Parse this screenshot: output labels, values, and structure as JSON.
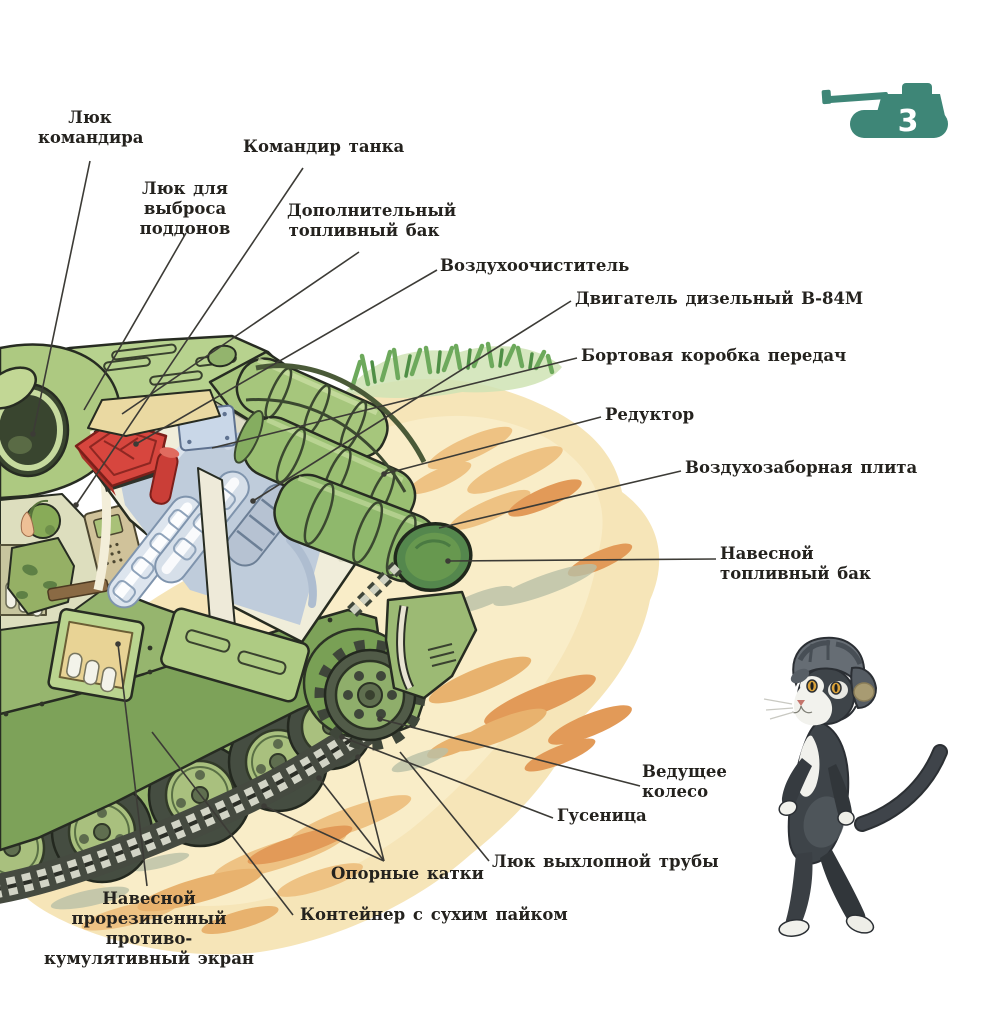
{
  "page": {
    "number": "3"
  },
  "theme": {
    "badge_color": "#3e8677",
    "text_color": "#24221e",
    "leader_line_color": "#3c3b36",
    "sand_color": "#f7e7bc",
    "tank_green": "#9cba74"
  },
  "labels": {
    "commander_hatch": "Люк\nкомандира",
    "tank_commander": "Командир танка",
    "pallet_ejection_hatch": "Люк для выброса\nподдонов",
    "additional_fuel_tank": "Дополнительный\nтопливный бак",
    "air_cleaner": "Воздухоочиститель",
    "diesel_engine": "Двигатель дизельный В-84М",
    "side_gearbox": "Бортовая коробка передач",
    "reduction_gear": "Редуктор",
    "air_intake_plate": "Воздухозаборная плита",
    "mounted_fuel_tank": "Навесной\nтопливный бак",
    "drive_wheel": "Ведущее\nколесо",
    "track": "Гусеница",
    "exhaust_pipe_hatch": "Люк выхлопной трубы",
    "road_wheels": "Опорные катки",
    "dry_ration_container": "Контейнер с сухим пайком",
    "anti_cumulative_screen": "Навесной\nпрорезиненный противо-\nкумулятивный экран"
  }
}
